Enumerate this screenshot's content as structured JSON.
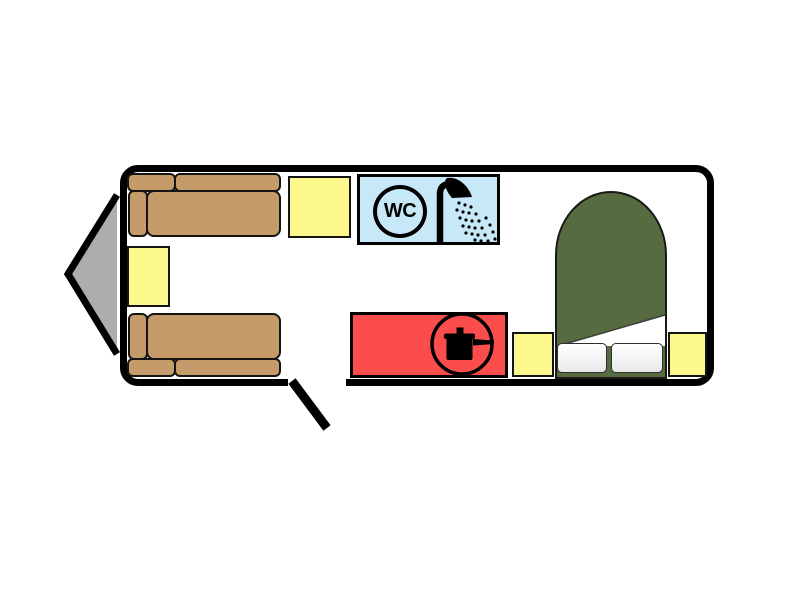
{
  "floorplan": {
    "colors": {
      "outline": "#000000",
      "body_fill": "#FFFFFF",
      "sofa": "#C69B6A",
      "cabinet": "#FDF88C",
      "bathroom": "#C7E8F6",
      "kitchen": "#FC4D4D",
      "bed": "#566B40",
      "hitch": "#ADADAD",
      "pillow": "#E9E9E9",
      "sheet": "#FFFFFF"
    },
    "bathroom": {
      "wc_label": "WC",
      "icons": [
        "wc-circle-sign",
        "shower-head-icon"
      ]
    },
    "kitchen": {
      "icons": [
        "cooking-pot-icon"
      ]
    },
    "lounge": {
      "furniture": [
        "sofa-upper",
        "sofa-lower",
        "wardrobe-cabinet",
        "front-cabinet"
      ]
    },
    "bedroom": {
      "furniture": [
        "french-double-bed",
        "turned-down-sheet",
        "pillow-left",
        "pillow-right",
        "bedside-cabinet-left",
        "bedside-cabinet-right"
      ]
    },
    "exterior": {
      "features": [
        "tow-hitch",
        "entry-door-open"
      ]
    }
  }
}
